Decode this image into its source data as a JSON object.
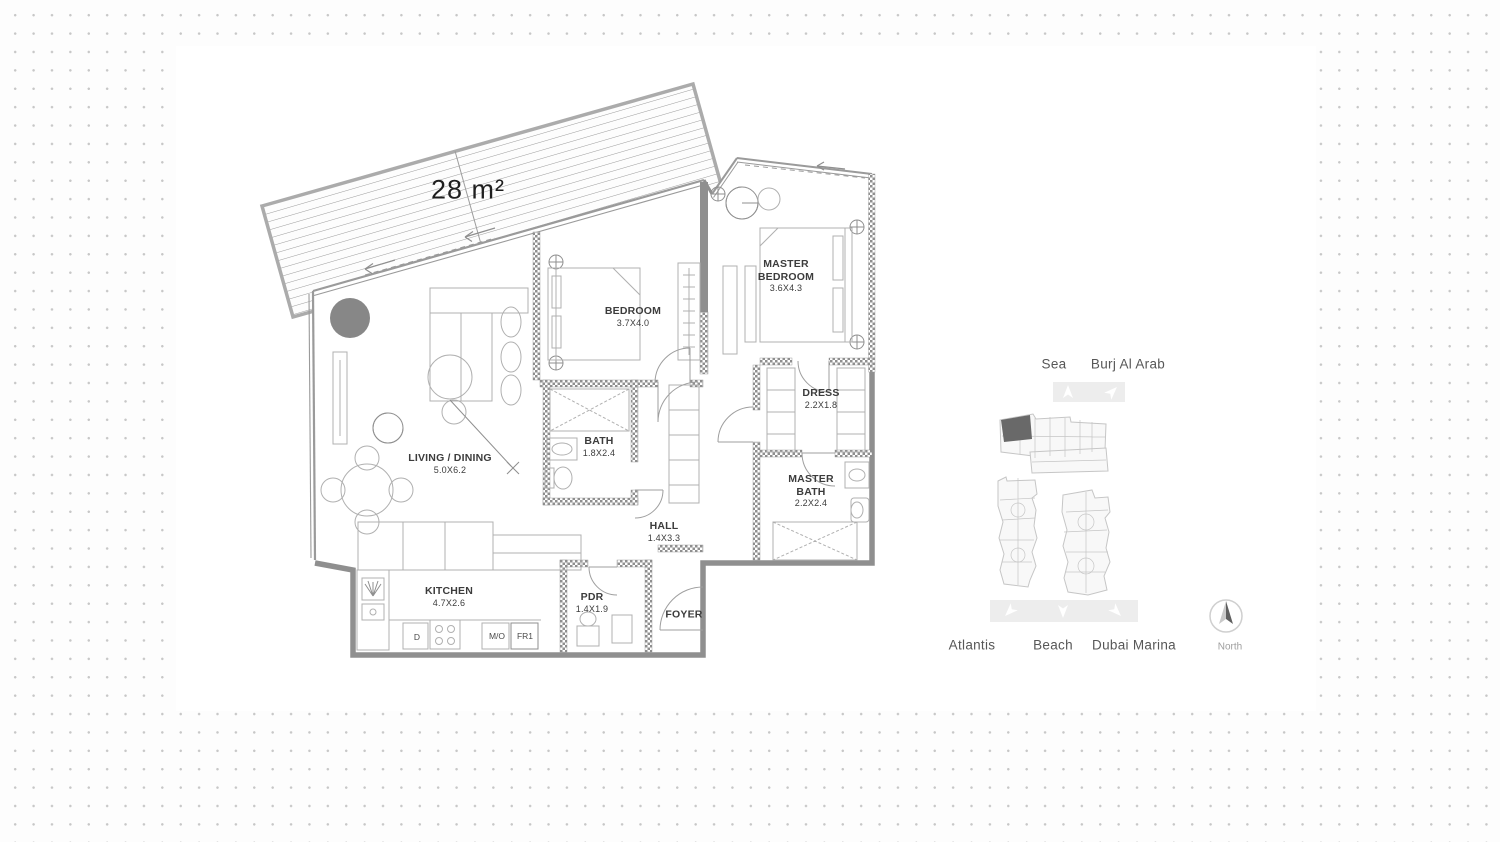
{
  "floor_plan": {
    "terrace": {
      "area_label": "28 m²"
    },
    "rooms": [
      {
        "name": "LIVING / DINING",
        "dims": "5.0X6.2"
      },
      {
        "name": "BEDROOM",
        "dims": "3.7X4.0"
      },
      {
        "name": "MASTER BEDROOM",
        "dims": "3.6X4.3"
      },
      {
        "name": "DRESS",
        "dims": "2.2X1.8"
      },
      {
        "name": "BATH",
        "dims": "1.8X2.4"
      },
      {
        "name": "MASTER BATH",
        "dims": "2.2X2.4"
      },
      {
        "name": "HALL",
        "dims": "1.4X3.3"
      },
      {
        "name": "PDR",
        "dims": "1.4X1.9"
      },
      {
        "name": "FOYER",
        "dims": ""
      },
      {
        "name": "KITCHEN",
        "dims": "4.7X2.6"
      }
    ],
    "appliances": [
      {
        "label": "D"
      },
      {
        "label": "M/O"
      },
      {
        "label": "FR1"
      }
    ],
    "colors": {
      "wall": "#8f8f8f",
      "hatch": "#9c9c9c",
      "furniture": "#b5b5b5"
    }
  },
  "key_plan": {
    "top_labels": [
      {
        "label": "Sea"
      },
      {
        "label": "Burj Al Arab"
      }
    ],
    "bottom_labels": [
      {
        "label": "Atlantis"
      },
      {
        "label": "Beach"
      },
      {
        "label": "Dubai Marina"
      }
    ],
    "compass": {
      "label": "North"
    },
    "colors": {
      "highlight_unit": "#696969",
      "direction_bar": "#ededed",
      "building_outline": "#c6c6c6"
    }
  }
}
